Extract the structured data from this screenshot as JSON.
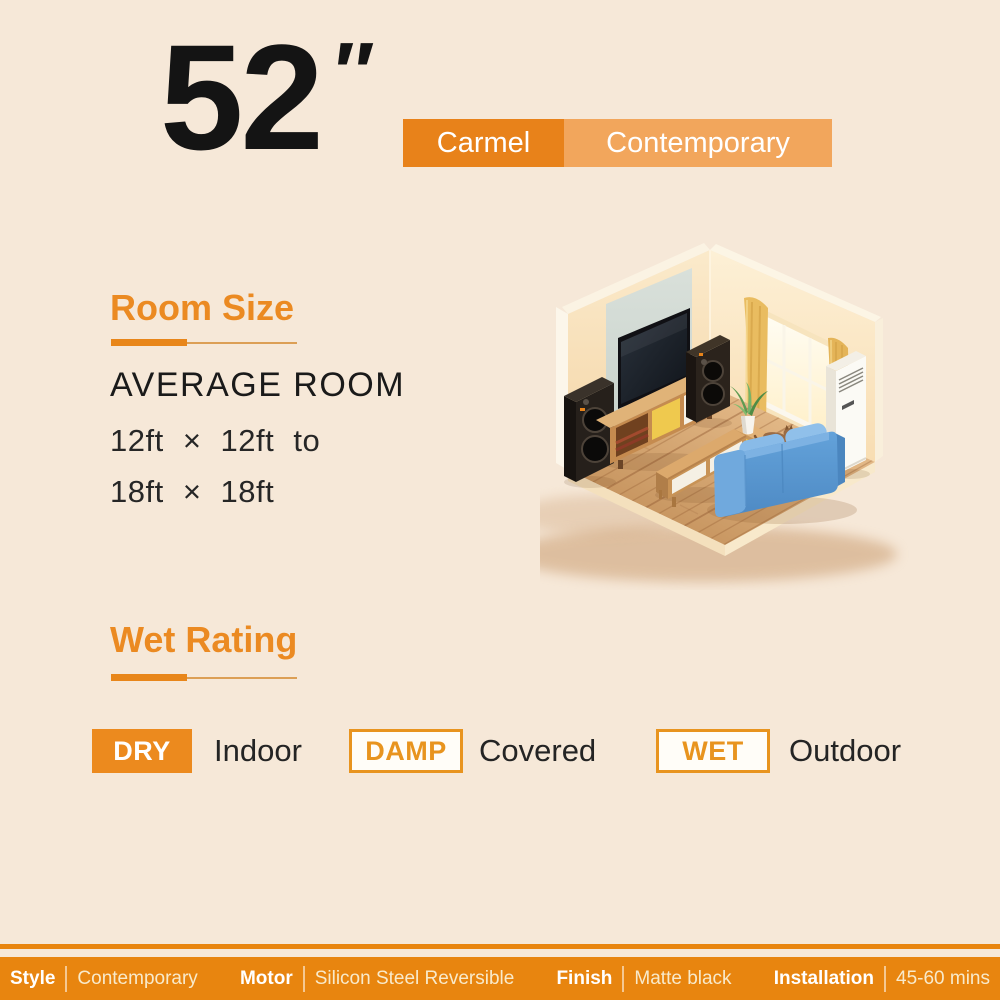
{
  "page": {
    "background_color": "#F6E8D8",
    "accent_color": "#E8861A",
    "accent_light_color": "#F2A65C",
    "footer_bar_color": "#E8850F"
  },
  "header": {
    "fan_size_value": "52",
    "fan_size_unit_mark": "″",
    "model_badge": "Carmel",
    "style_badge": "Contemporary"
  },
  "room_size": {
    "title": "Room Size",
    "subtitle": "AVERAGE ROOM",
    "range_line_1": "12ft × 12ft to",
    "range_line_2": "18ft × 18ft"
  },
  "wet_rating": {
    "title": "Wet Rating",
    "ratings": [
      {
        "badge": "DRY",
        "location": "Indoor",
        "variant": "filled"
      },
      {
        "badge": "DAMP",
        "location": "Covered",
        "variant": "outline"
      },
      {
        "badge": "WET",
        "location": "Outdoor",
        "variant": "outline"
      }
    ]
  },
  "footer": {
    "specs": [
      {
        "label": "Style",
        "value": "Contemporary"
      },
      {
        "label": "Motor",
        "value": "Silicon Steel Reversible"
      },
      {
        "label": "Finish",
        "value": "Matte black"
      },
      {
        "label": "Installation",
        "value": "45-60 mins"
      }
    ]
  },
  "illustration": {
    "alt": "Isometric living room with wall-mounted TV, two floor speakers, wooden TV stand, blue sofa, coffee table, console with plant and cat, bright window with golden curtains and a floor-standing air conditioner"
  }
}
